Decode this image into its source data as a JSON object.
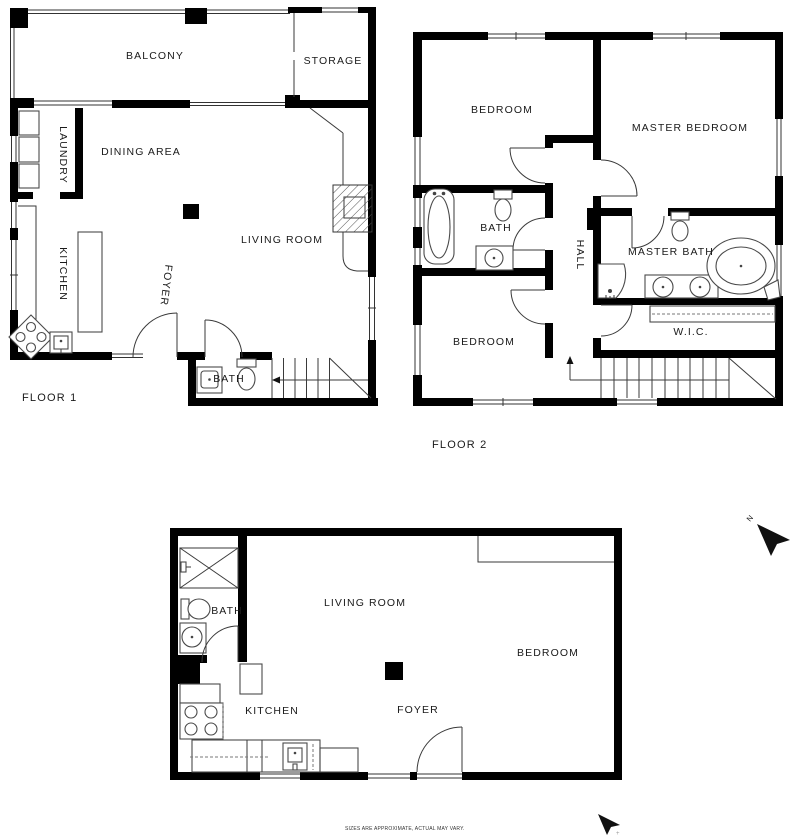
{
  "floor1": {
    "name": "FLOOR 1",
    "rooms": {
      "balcony": "BALCONY",
      "storage": "STORAGE",
      "laundry": "LAUNDRY",
      "dining_area": "DINING AREA",
      "kitchen": "KITCHEN",
      "living_room": "LIVING ROOM",
      "foyer": "FOYER",
      "bath": "BATH"
    }
  },
  "floor2": {
    "name": "FLOOR 2",
    "rooms": {
      "bedroom_top": "BEDROOM",
      "master_bedroom": "MASTER BEDROOM",
      "bath": "BATH",
      "hall": "HALL",
      "master_bath": "MASTER BATH",
      "bedroom_bottom": "BEDROOM",
      "walk_in_closet": "W.I.C."
    }
  },
  "lower_floor": {
    "rooms": {
      "living_room": "LIVING ROOM",
      "bedroom": "BEDROOM",
      "bath": "BATH",
      "kitchen": "KITCHEN",
      "foyer": "FOYER"
    }
  },
  "compass": {
    "north_label": "N",
    "tick": "+"
  },
  "footer": {
    "disclaimer": "SIZES ARE APPROXIMATE, ACTUAL MAY VARY."
  }
}
